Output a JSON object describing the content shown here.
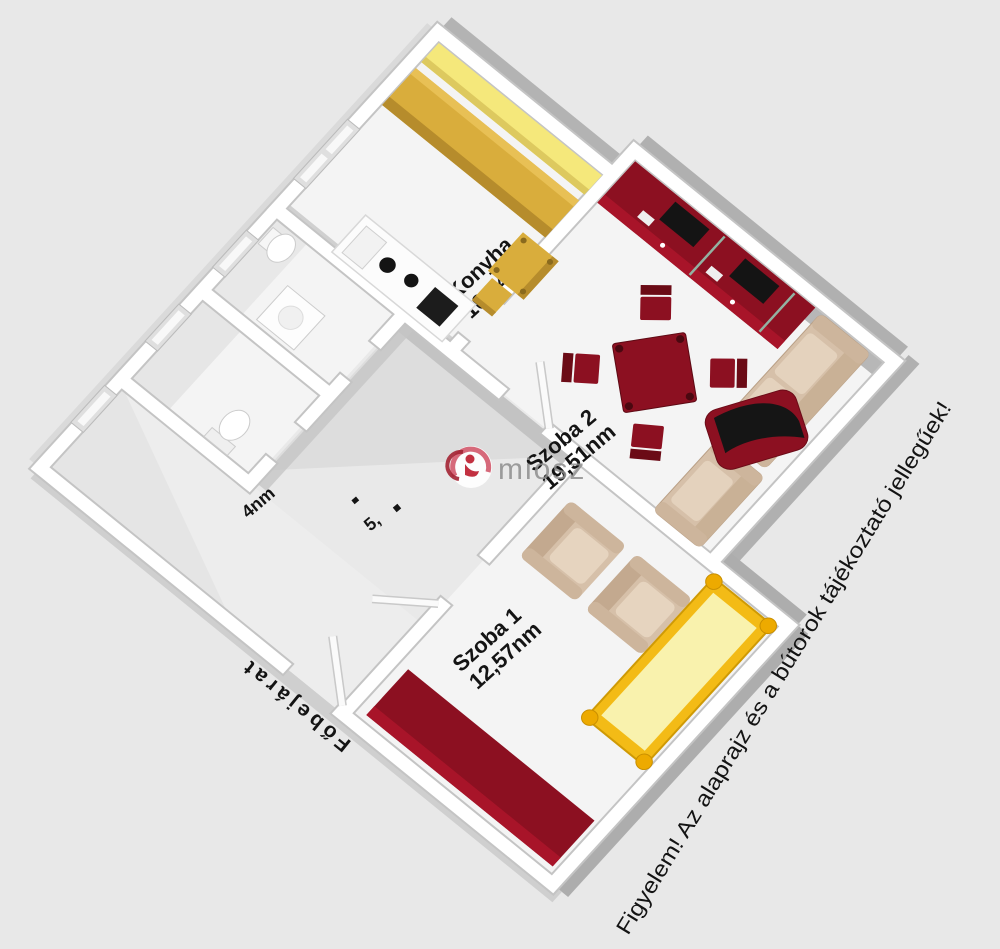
{
  "rooms": [
    {
      "name": "Konyha",
      "area": "10,54nm"
    },
    {
      "name": "Szoba 2",
      "area": "19,51nm"
    },
    {
      "name": "Szoba 1",
      "area": "12,57nm"
    }
  ],
  "partial_labels": {
    "room_4nm": "4nm",
    "hall": "5,"
  },
  "labels": {
    "entrance": "Főbejárat",
    "disclaimer": "Figyelem! Az alaprajz és a bútorok tájékoztató jellegűek!"
  },
  "watermark": {
    "brand": "miosz"
  },
  "colors": {
    "background": "#e8e8e8",
    "floor": "#f4f4f4",
    "wall": "#ffffff",
    "furniture_red": "#8c1021",
    "cabinet_yellow": "#f5e87b",
    "counter_gold": "#d9ad3c",
    "bed_yellow": "#f9f2ad",
    "bed_frame_gold": "#f3bb16",
    "sofa_beige": "#d6c0a9",
    "label_text": "#141414",
    "watermark_gray": "#8e8e8e"
  }
}
